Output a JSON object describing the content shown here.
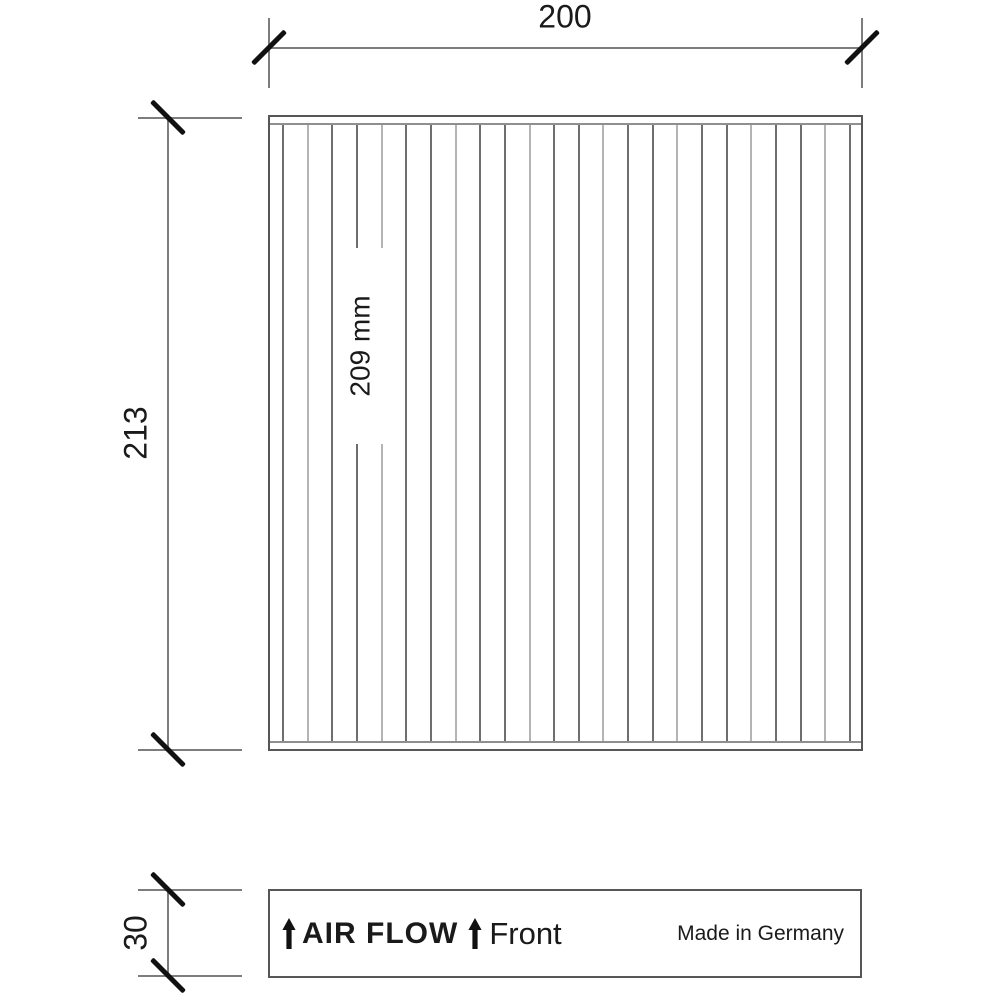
{
  "dimensions": {
    "width": {
      "label": "200"
    },
    "height": {
      "label": "213"
    },
    "pleat_depth": {
      "label": "209 mm"
    },
    "frame_height": {
      "label": "30"
    }
  },
  "bottom_panel": {
    "air_flow": "AIR FLOW",
    "front": "Front",
    "made_in": "Made in Germany"
  },
  "pleats": {
    "count": 24
  },
  "colors": {
    "line": "#7d7d7d",
    "border": "#565656",
    "tick": "#111111",
    "text": "#1a1a1a",
    "pleat_dark": "#6e6e6e",
    "pleat_light": "#b4b4b4"
  }
}
